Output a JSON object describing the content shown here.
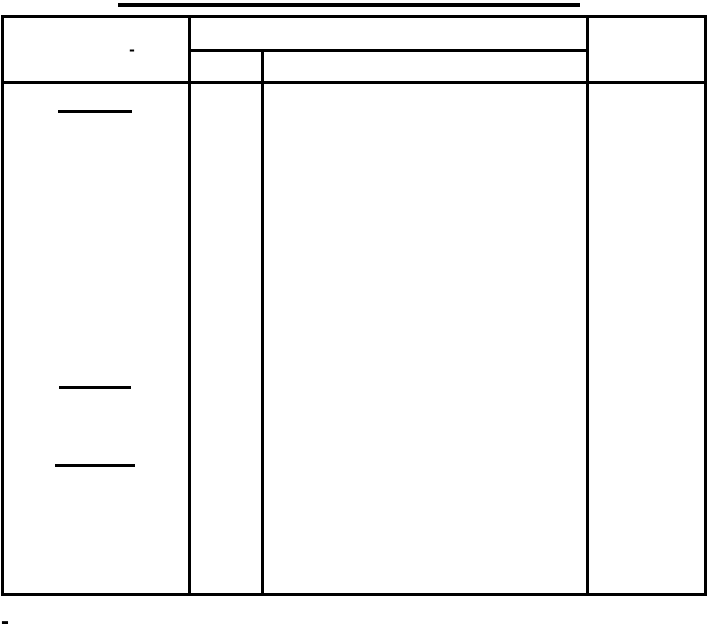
{
  "document": {
    "header": {
      "left_cell_text": "-"
    },
    "footnote": {
      "marker": "-"
    },
    "colors": {
      "ink": "#000000",
      "paper": "#ffffff"
    }
  }
}
